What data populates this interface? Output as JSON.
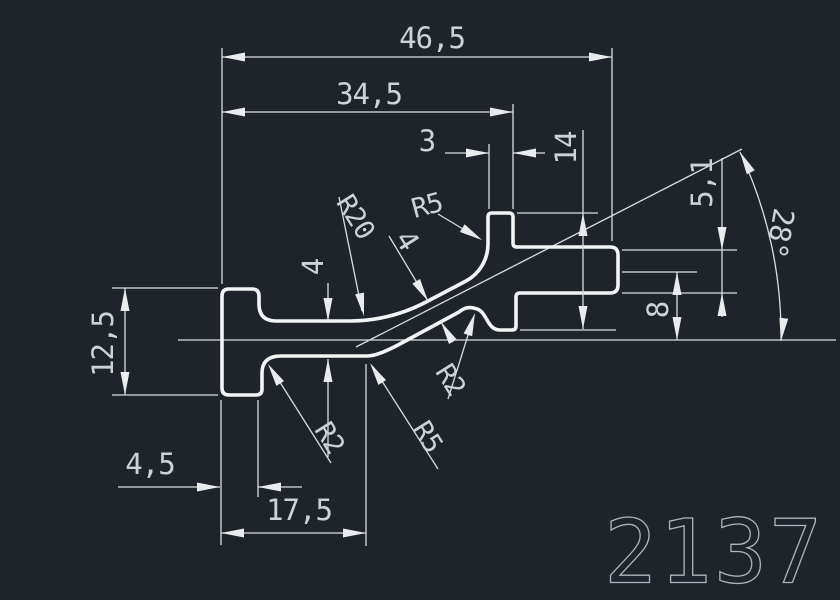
{
  "drawing": {
    "part_number": "2137",
    "labels": {
      "total_width": "46,5",
      "upper_width": "34,5",
      "stem_width": "3",
      "head_height": "14",
      "arm_thickness": "5,1",
      "angle": "28°",
      "flange_height": "12,5",
      "arm_offset": "8",
      "web_thickness": "4",
      "diagonal_thickness": "4",
      "radius_top_large": "R20",
      "radius_top_small": "R5",
      "radius_bottom_left": "R2",
      "radius_bottom_mid": "R5",
      "radius_bottom_right": "R2",
      "flange_width": "4,5",
      "bottom_length": "17,5"
    },
    "colors": {
      "background": "#1f242b",
      "profile_line": "#f3f4f5",
      "dimension_line": "#d9dde1",
      "text": "#cdd2d7",
      "part_number_color": "#aeb4bb"
    }
  }
}
